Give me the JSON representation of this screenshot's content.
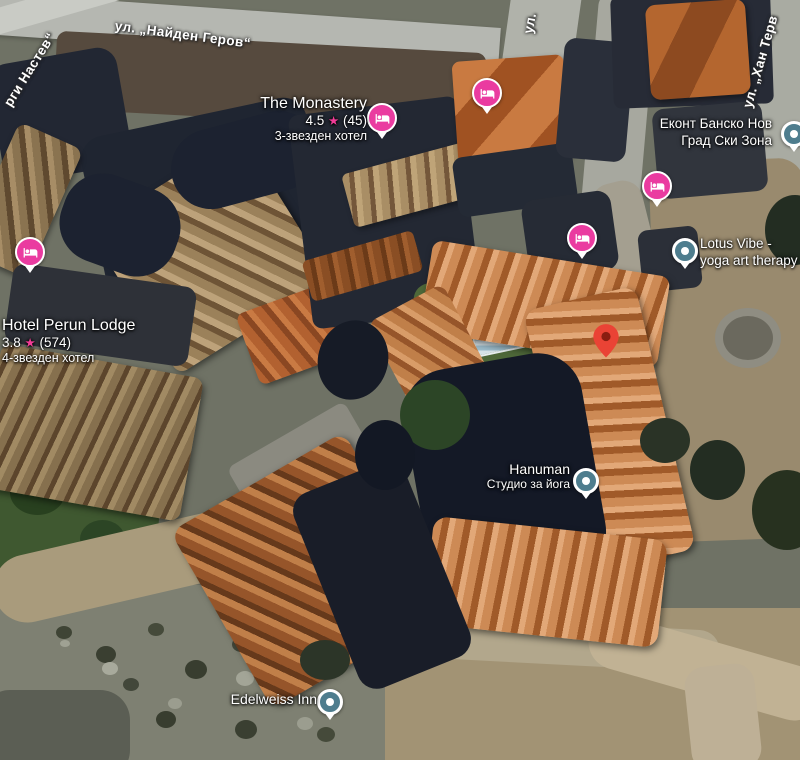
{
  "map": {
    "streets": {
      "naiden_gerov": "ул. „Найден Геров“",
      "left_fragment": "рги Настев“",
      "top_fragment": "ул.",
      "han_terv": "ул. „Хан Терв"
    },
    "places": {
      "monastery": {
        "name": "The Monastery",
        "rating": "4.5",
        "reviews": "(45)",
        "subtitle": "3-звезден хотел"
      },
      "perun": {
        "name": "Hotel Perun Lodge",
        "rating": "3.8",
        "reviews": "(574)",
        "subtitle": "4-звезден хотел"
      },
      "ekont": {
        "line1": "Еконт Банско Нов",
        "line2": "Град Ски Зона"
      },
      "lotus": {
        "line1": "Lotus Vibe -",
        "line2": "yoga art therapy"
      },
      "hanuman": {
        "name": "Hanuman",
        "subtitle": "Студио за йога"
      },
      "edelweiss": {
        "name": "Edelweiss Inn"
      }
    },
    "icons": {
      "star": "★"
    },
    "colors": {
      "hotel_marker_pink": "#ea3ba0",
      "poi_marker_teal": "#4e7d8e",
      "location_pin_red": "#ea4335",
      "rating_star_pink": "#f23c97",
      "label_text": "#ffffff"
    }
  }
}
